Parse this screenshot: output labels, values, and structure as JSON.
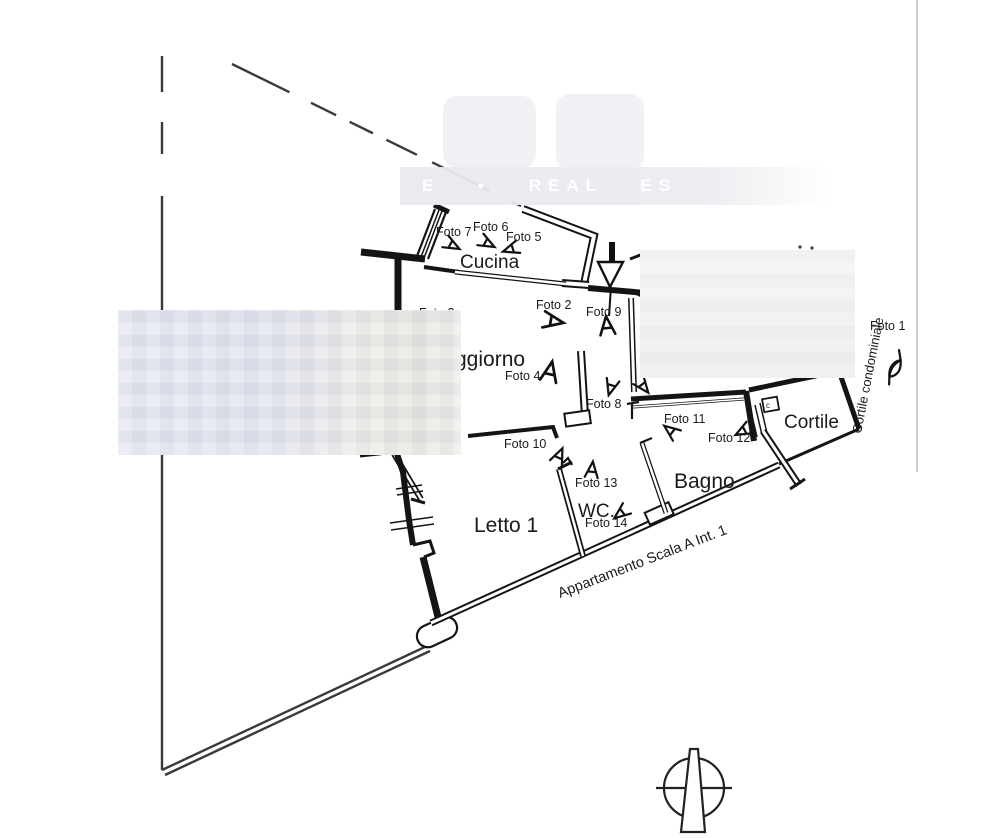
{
  "watermark": {
    "band_text": "E • REAL ES"
  },
  "plan": {
    "rooms": [
      {
        "label": "Cucina"
      },
      {
        "label": "ggiorno"
      },
      {
        "label": "Letto 1"
      },
      {
        "label": "WC."
      },
      {
        "label": "Bagno"
      },
      {
        "label": "Cortile"
      }
    ],
    "photos": [
      {
        "label": "Foto 1"
      },
      {
        "label": "Foto 2"
      },
      {
        "label": "Foto 3"
      },
      {
        "label": "Foto 4"
      },
      {
        "label": "Foto 5"
      },
      {
        "label": "Foto 6"
      },
      {
        "label": "Foto 7"
      },
      {
        "label": "Foto 8"
      },
      {
        "label": "Foto 9"
      },
      {
        "label": "Foto 10"
      },
      {
        "label": "Foto 11"
      },
      {
        "label": "Foto 12"
      },
      {
        "label": "Foto 13"
      },
      {
        "label": "Foto 14"
      }
    ],
    "annotations": {
      "apartment": "Appartamento Scala A Int. 1",
      "courtyard": "Cortile condominiale",
      "utility_box": "c"
    }
  }
}
